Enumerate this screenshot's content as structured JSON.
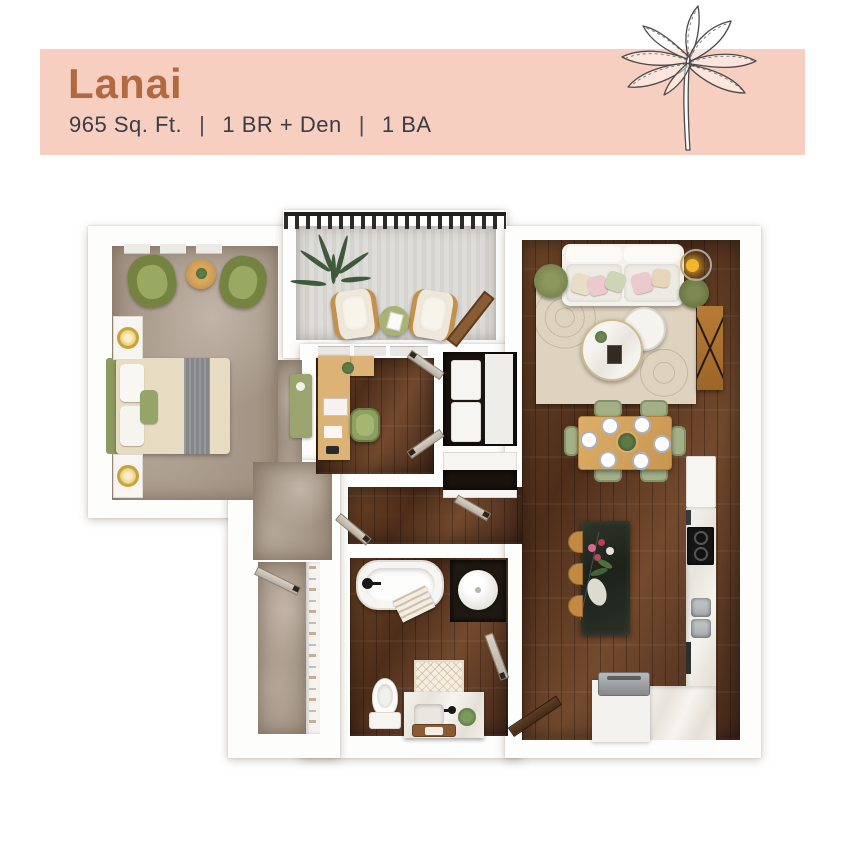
{
  "header": {
    "title": "Lanai",
    "area": "965 Sq. Ft.",
    "separator": "|",
    "bed_spec": "1 BR + Den",
    "bath_spec": "1 BA"
  },
  "illustration": {
    "icon": "banana-palm-sketch-icon"
  },
  "colors": {
    "banner": "#f7cfc1",
    "title": "#b2693f",
    "subtitle": "#3b3c45",
    "carpet": "#a29383",
    "wood_floor": "#5a3a22",
    "balcony_concrete": "#d8d6d2",
    "accent_green": "#8da05f",
    "accent_wood": "#c08b45",
    "kitchen_island": "#262c22",
    "railing": "#1f1f1f"
  }
}
